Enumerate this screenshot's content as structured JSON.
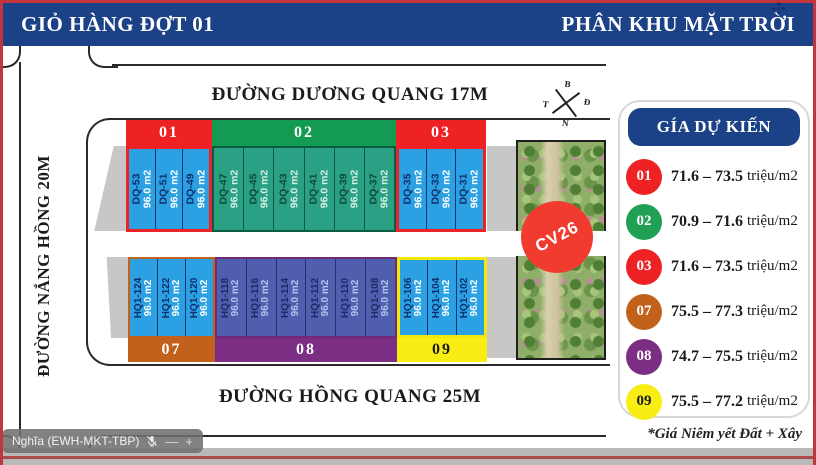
{
  "header": {
    "left_title": "GIỎ HÀNG ĐỢT 01",
    "right_title": "PHÂN KHU MẶT TRỜI"
  },
  "streets": {
    "top": "ĐƯỜNG DƯƠNG QUANG 17M",
    "bottom": "ĐƯỜNG HỒNG QUANG 25M",
    "left": "ĐƯỜNG NẮNG HỒNG 20M"
  },
  "compass": {
    "north": "B",
    "east": "Đ",
    "west": "T",
    "south": "N"
  },
  "park_label": "CV26",
  "blocks": [
    {
      "id": "01",
      "colors": {
        "band": "#ee2124",
        "plot_bg": "#2ba0e2",
        "plot_border": "#16366f",
        "id": "#0e2f6e",
        "area": "#ffffff",
        "outline": "#ee2124"
      },
      "plots": [
        {
          "name": "DQ-53",
          "area": "96.0 m2"
        },
        {
          "name": "DQ-51",
          "area": "96.0 m2"
        },
        {
          "name": "DQ-49",
          "area": "96.0 m2"
        }
      ]
    },
    {
      "id": "02",
      "colors": {
        "band": "#149b52",
        "plot_bg": "#2aa184",
        "plot_border": "#0a5a40",
        "id": "#0c4a3c",
        "area": "#d5f0e2",
        "outline": "#0b5c40"
      },
      "plots": [
        {
          "name": "DQ-47",
          "area": "96.0 m2"
        },
        {
          "name": "DQ-45",
          "area": "96.0 m2"
        },
        {
          "name": "DQ-43",
          "area": "96.0 m2"
        },
        {
          "name": "DQ-41",
          "area": "96.0 m2"
        },
        {
          "name": "DQ-39",
          "area": "96.0 m2"
        },
        {
          "name": "DQ-37",
          "area": "96.0 m2"
        }
      ]
    },
    {
      "id": "03",
      "colors": {
        "band": "#ee2124",
        "plot_bg": "#2ba0e2",
        "plot_border": "#16366f",
        "id": "#0e2f6e",
        "area": "#ffffff",
        "outline": "#ee2124"
      },
      "plots": [
        {
          "name": "DQ-35",
          "area": "96.0 m2"
        },
        {
          "name": "DQ-33",
          "area": "96.0 m2"
        },
        {
          "name": "DQ-31",
          "area": "96.0 m2"
        }
      ]
    },
    {
      "id": "07",
      "colors": {
        "band": "#c2611c",
        "plot_bg": "#2ba0e2",
        "plot_border": "#16366f",
        "id": "#0e2f6e",
        "area": "#ffffff",
        "outline": "#c2611c"
      },
      "plots": [
        {
          "name": "HQ1-124",
          "area": "96.0 m2"
        },
        {
          "name": "HQ1-122",
          "area": "96.0 m2"
        },
        {
          "name": "HQ1-120",
          "area": "96.0 m2"
        }
      ]
    },
    {
      "id": "08",
      "colors": {
        "band": "#7b2e84",
        "plot_bg": "#4f5fae",
        "plot_border": "#25306e",
        "id": "#1d2a66",
        "area": "#b7c1ee",
        "outline": "#6e2a77"
      },
      "plots": [
        {
          "name": "HQ1-118",
          "area": "96.0 m2"
        },
        {
          "name": "HQ1-116",
          "area": "96.0 m2"
        },
        {
          "name": "HQ1-114",
          "area": "96.0 m2"
        },
        {
          "name": "HQ1-112",
          "area": "96.0 m2"
        },
        {
          "name": "HQ1-110",
          "area": "96.0 m2"
        },
        {
          "name": "HQ1-108",
          "area": "96.0 m2"
        }
      ]
    },
    {
      "id": "09",
      "colors": {
        "band": "#f8ee14",
        "band_text": "#1a1a1a",
        "plot_bg": "#2ba0e2",
        "plot_border": "#16366f",
        "id": "#0e2f6e",
        "area": "#ffffff",
        "outline": "#f2e70e"
      },
      "plots": [
        {
          "name": "HQ1-106",
          "area": "96.0 m2"
        },
        {
          "name": "HQ1-104",
          "area": "96.0 m2"
        },
        {
          "name": "HQ1-102",
          "area": "96.0 m2"
        }
      ]
    }
  ],
  "legend": {
    "title": "GÍA DỰ KIẾN",
    "rows": [
      {
        "block": "01",
        "color": "#ee2124",
        "text": "#ffffff",
        "range": "71.6 – 73.5",
        "unit": "triệu/m2"
      },
      {
        "block": "02",
        "color": "#1fa055",
        "text": "#ffffff",
        "range": "70.9 – 71.6",
        "unit": "triệu/m2"
      },
      {
        "block": "03",
        "color": "#ee2124",
        "text": "#ffffff",
        "range": "71.6 – 73.5",
        "unit": "triệu/m2"
      },
      {
        "block": "07",
        "color": "#c2611c",
        "text": "#ffffff",
        "range": "75.5 – 77.3",
        "unit": "triệu/m2"
      },
      {
        "block": "08",
        "color": "#7b2e84",
        "text": "#ffffff",
        "range": "74.7 – 75.5",
        "unit": "triệu/m2"
      },
      {
        "block": "09",
        "color": "#f8ee14",
        "text": "#1a1a1a",
        "range": "75.5 – 77.2",
        "unit": "triệu/m2"
      }
    ],
    "footnote": "*Giá Niêm yết Đất + Xây"
  },
  "overlay": {
    "participant": "Nghĩa (EWH-MKT-TBP)",
    "minus": "—",
    "plus": "+"
  }
}
